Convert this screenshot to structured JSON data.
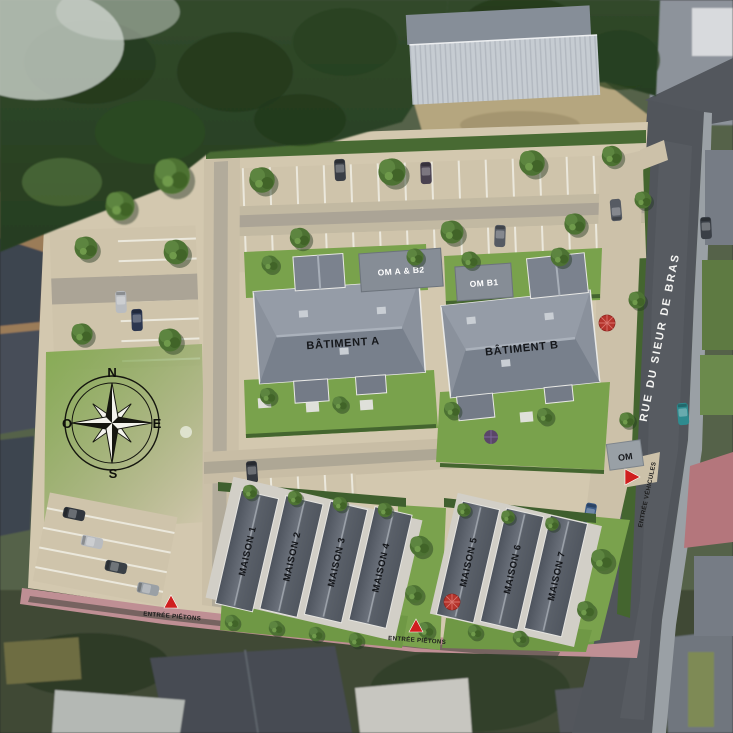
{
  "site": {
    "street": {
      "name": "RUE DU SIEUR DE BRAS"
    },
    "buildings": [
      {
        "id": "batiment-a",
        "label": "BÂTIMENT A"
      },
      {
        "id": "batiment-b",
        "label": "BÂTIMENT B"
      }
    ],
    "annexes": [
      {
        "id": "om-a-b2",
        "label": "OM A & B2"
      },
      {
        "id": "om-b1",
        "label": "OM B1"
      },
      {
        "id": "om",
        "label": "OM"
      }
    ],
    "houses": [
      {
        "label": "MAISON 1"
      },
      {
        "label": "MAISON 2"
      },
      {
        "label": "MAISON 3"
      },
      {
        "label": "MAISON 4"
      },
      {
        "label": "MAISON 5"
      },
      {
        "label": "MAISON 6"
      },
      {
        "label": "MAISON 7"
      }
    ],
    "entrances": [
      {
        "label": "ENTRÉE PIÉTONS"
      },
      {
        "label": "ENTRÉE PIÉTONS"
      },
      {
        "label": "ENTRÉE VÉHICULES"
      }
    ],
    "compass": {
      "n": "N",
      "e": "E",
      "s": "S",
      "o": "O"
    }
  },
  "colors": {
    "lawn": "#7fa650",
    "paving": "#d3c8af",
    "hedge": "#44652f",
    "roof_house": "#565c66",
    "roof_building": "#8a919c",
    "road": "#51555b",
    "marker_red": "#cf1f1f"
  }
}
